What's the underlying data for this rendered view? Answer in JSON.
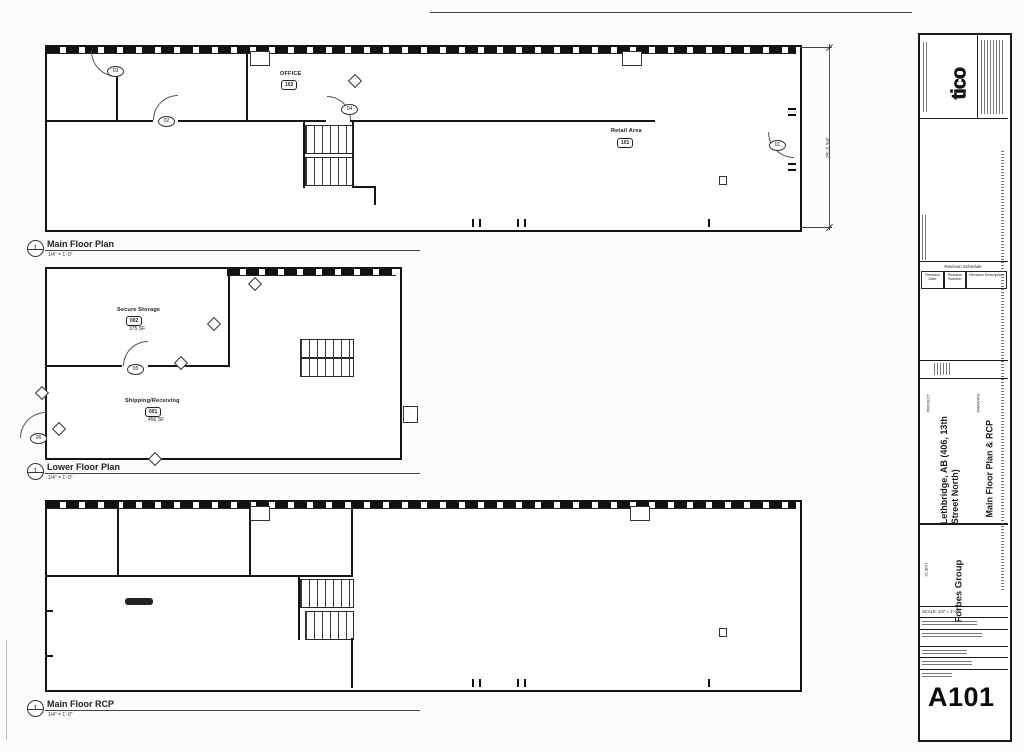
{
  "plans": [
    {
      "callout": "1",
      "title": "Main Floor Plan",
      "scale": "1/4\" = 1'-0\""
    },
    {
      "callout": "1",
      "title": "Lower Floor Plan",
      "scale": "1/4\" = 1'-0\""
    },
    {
      "callout": "1",
      "title": "Main Floor RCP",
      "scale": "1/4\" = 1'-0\""
    }
  ],
  "main_floor": {
    "rooms": [
      {
        "name": "OFFICE",
        "number": "102"
      },
      {
        "name": "Retail Area",
        "number": "101"
      }
    ],
    "door_tags": [
      "01",
      "02",
      "03",
      "04"
    ],
    "dimension": "25'-3 3/4\""
  },
  "lower_floor": {
    "rooms": [
      {
        "name": "Secure Storage",
        "number": "002",
        "area": "375 SF"
      },
      {
        "name": "Shipping/Receiving",
        "number": "001",
        "area": "456 SF"
      }
    ],
    "door_tags": [
      "05",
      "06"
    ]
  },
  "titleblock": {
    "logo": "tico",
    "revision": {
      "header": "Revision Schedule",
      "columns": [
        "Revision Date",
        "Revision Number",
        "Revision Description"
      ]
    },
    "project_label": "PROJECT",
    "project_line1": "Lethbridge, AB (406, 13th",
    "project_line2": "Street North)",
    "drawing_label": "DRAWING",
    "drawing": "Main Floor Plan & RCP",
    "client_label": "CLIENT",
    "client": "Forbes Group",
    "scale_note": "SCALE: 1/4\" = 1'-0\"",
    "sheet_number": "A101"
  }
}
